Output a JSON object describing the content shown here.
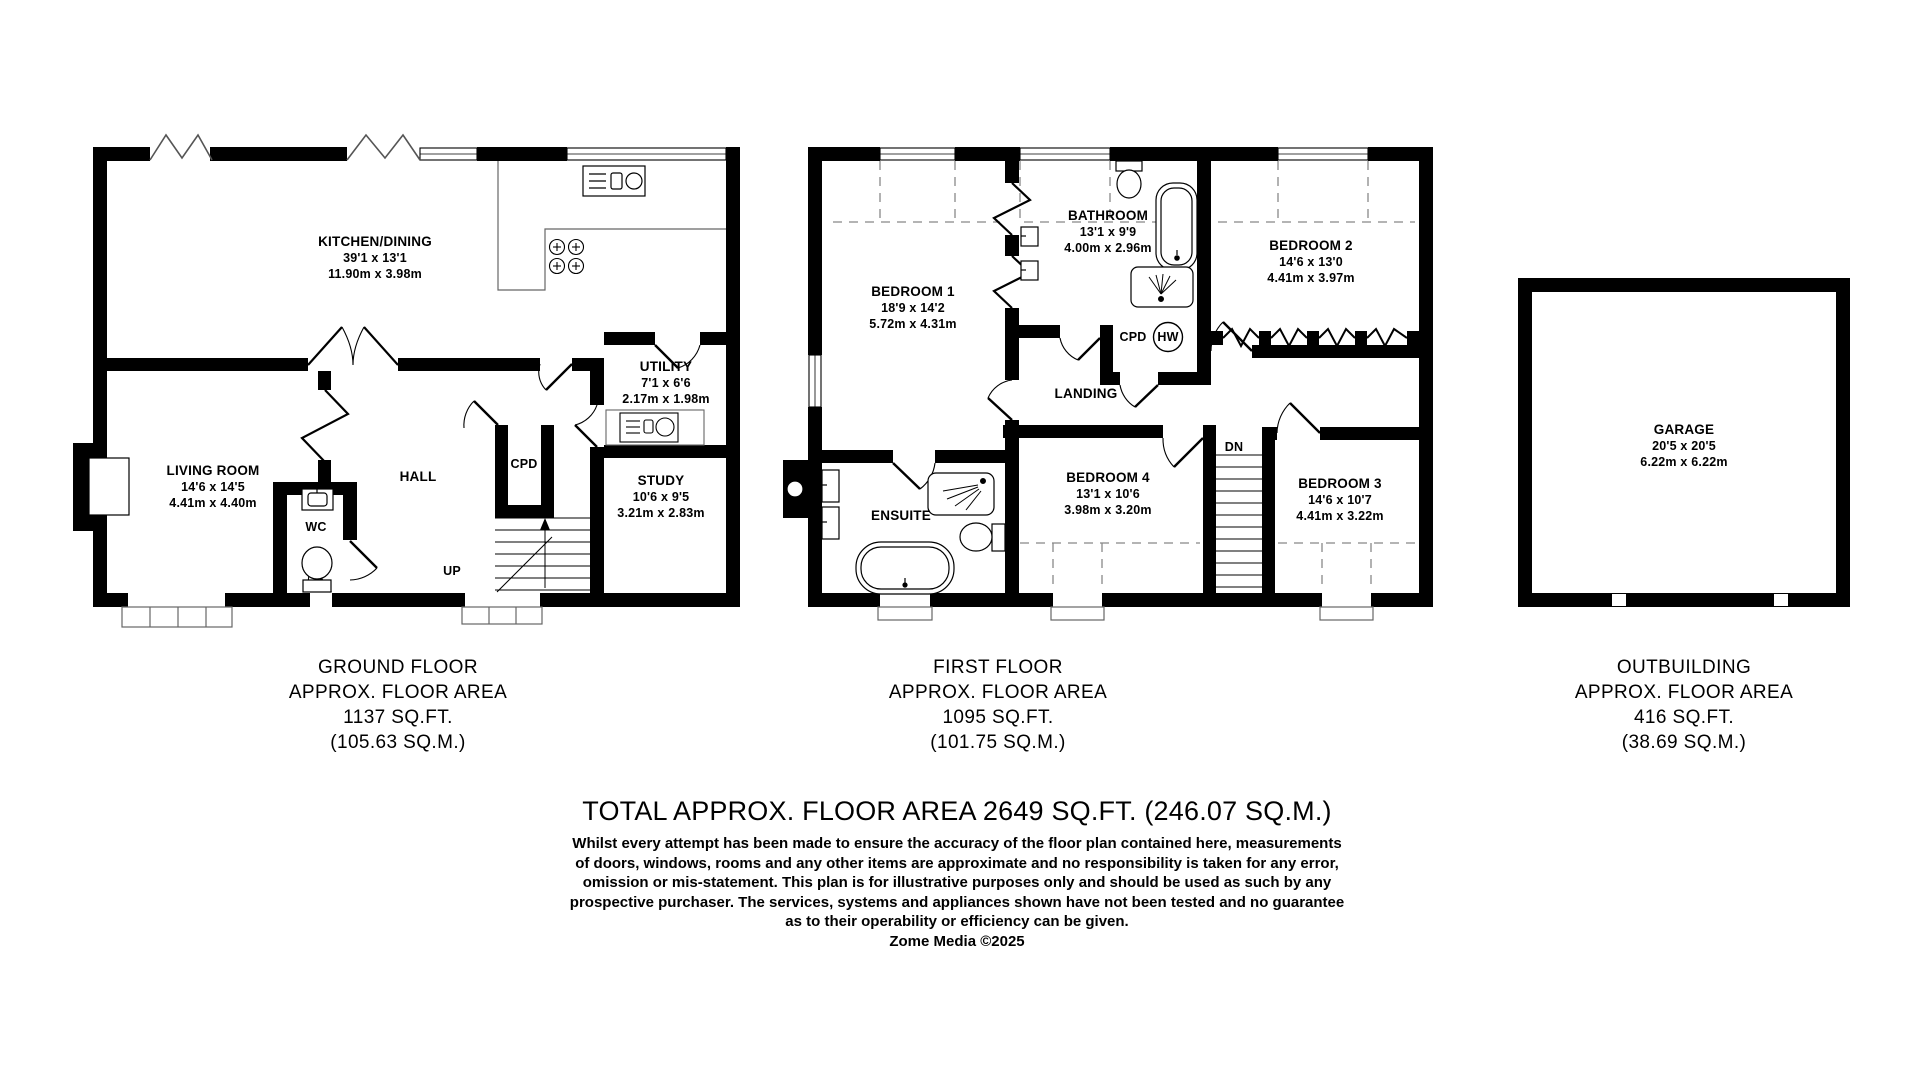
{
  "title_block": {
    "total": "TOTAL APPROX. FLOOR AREA 2649 SQ.FT. (246.07 SQ.M.)",
    "disclaimer": [
      "Whilst every attempt has been made to ensure the accuracy of the floor plan contained here, measurements",
      "of doors, windows, rooms and any other items are approximate and no responsibility is taken for any error,",
      "omission or mis-statement. This plan is for illustrative purposes only and should be used as such by any",
      "prospective purchaser. The services, systems and appliances shown have not been tested and no guarantee",
      "as to their operability or efficiency can be given."
    ],
    "credit": "Zome Media ©2025"
  },
  "floors": {
    "ground": {
      "label": [
        "GROUND FLOOR",
        "APPROX. FLOOR AREA",
        "1137 SQ.FT.",
        "(105.63 SQ.M.)"
      ],
      "rooms": {
        "kitchen": {
          "name": "KITCHEN/DINING",
          "imperial": "39'1 x 13'1",
          "metric": "11.90m x 3.98m"
        },
        "living": {
          "name": "LIVING ROOM",
          "imperial": "14'6 x 14'5",
          "metric": "4.41m x 4.40m"
        },
        "hall": {
          "name": "HALL"
        },
        "cupboard": {
          "name": "CPD"
        },
        "wc": {
          "name": "WC"
        },
        "utility": {
          "name": "UTILITY",
          "imperial": "7'1 x 6'6",
          "metric": "2.17m x 1.98m"
        },
        "study": {
          "name": "STUDY",
          "imperial": "10'6 x 9'5",
          "metric": "3.21m x 2.83m"
        },
        "stairs": {
          "name": "UP"
        }
      }
    },
    "first": {
      "label": [
        "FIRST FLOOR",
        "APPROX. FLOOR AREA",
        "1095 SQ.FT.",
        "(101.75 SQ.M.)"
      ],
      "rooms": {
        "bedroom1": {
          "name": "BEDROOM 1",
          "imperial": "18'9 x 14'2",
          "metric": "5.72m x 4.31m"
        },
        "bathroom": {
          "name": "BATHROOM",
          "imperial": "13'1 x 9'9",
          "metric": "4.00m x 2.96m"
        },
        "bedroom2": {
          "name": "BEDROOM 2",
          "imperial": "14'6 x 13'0",
          "metric": "4.41m x 3.97m"
        },
        "bedroom3": {
          "name": "BEDROOM 3",
          "imperial": "14'6 x 10'7",
          "metric": "4.41m x 3.22m"
        },
        "bedroom4": {
          "name": "BEDROOM 4",
          "imperial": "13'1 x 10'6",
          "metric": "3.98m x 3.20m"
        },
        "landing": {
          "name": "LANDING"
        },
        "ensuite": {
          "name": "ENSUITE"
        },
        "cupboard": {
          "name": "CPD"
        },
        "hot_water": {
          "name": "HW"
        },
        "stairs": {
          "name": "DN"
        }
      }
    },
    "outbuilding": {
      "label": [
        "OUTBUILDING",
        "APPROX. FLOOR AREA",
        "416 SQ.FT.",
        "(38.69 SQ.M.)"
      ],
      "rooms": {
        "garage": {
          "name": "GARAGE",
          "imperial": "20'5 x 20'5",
          "metric": "6.22m x 6.22m"
        }
      }
    }
  }
}
